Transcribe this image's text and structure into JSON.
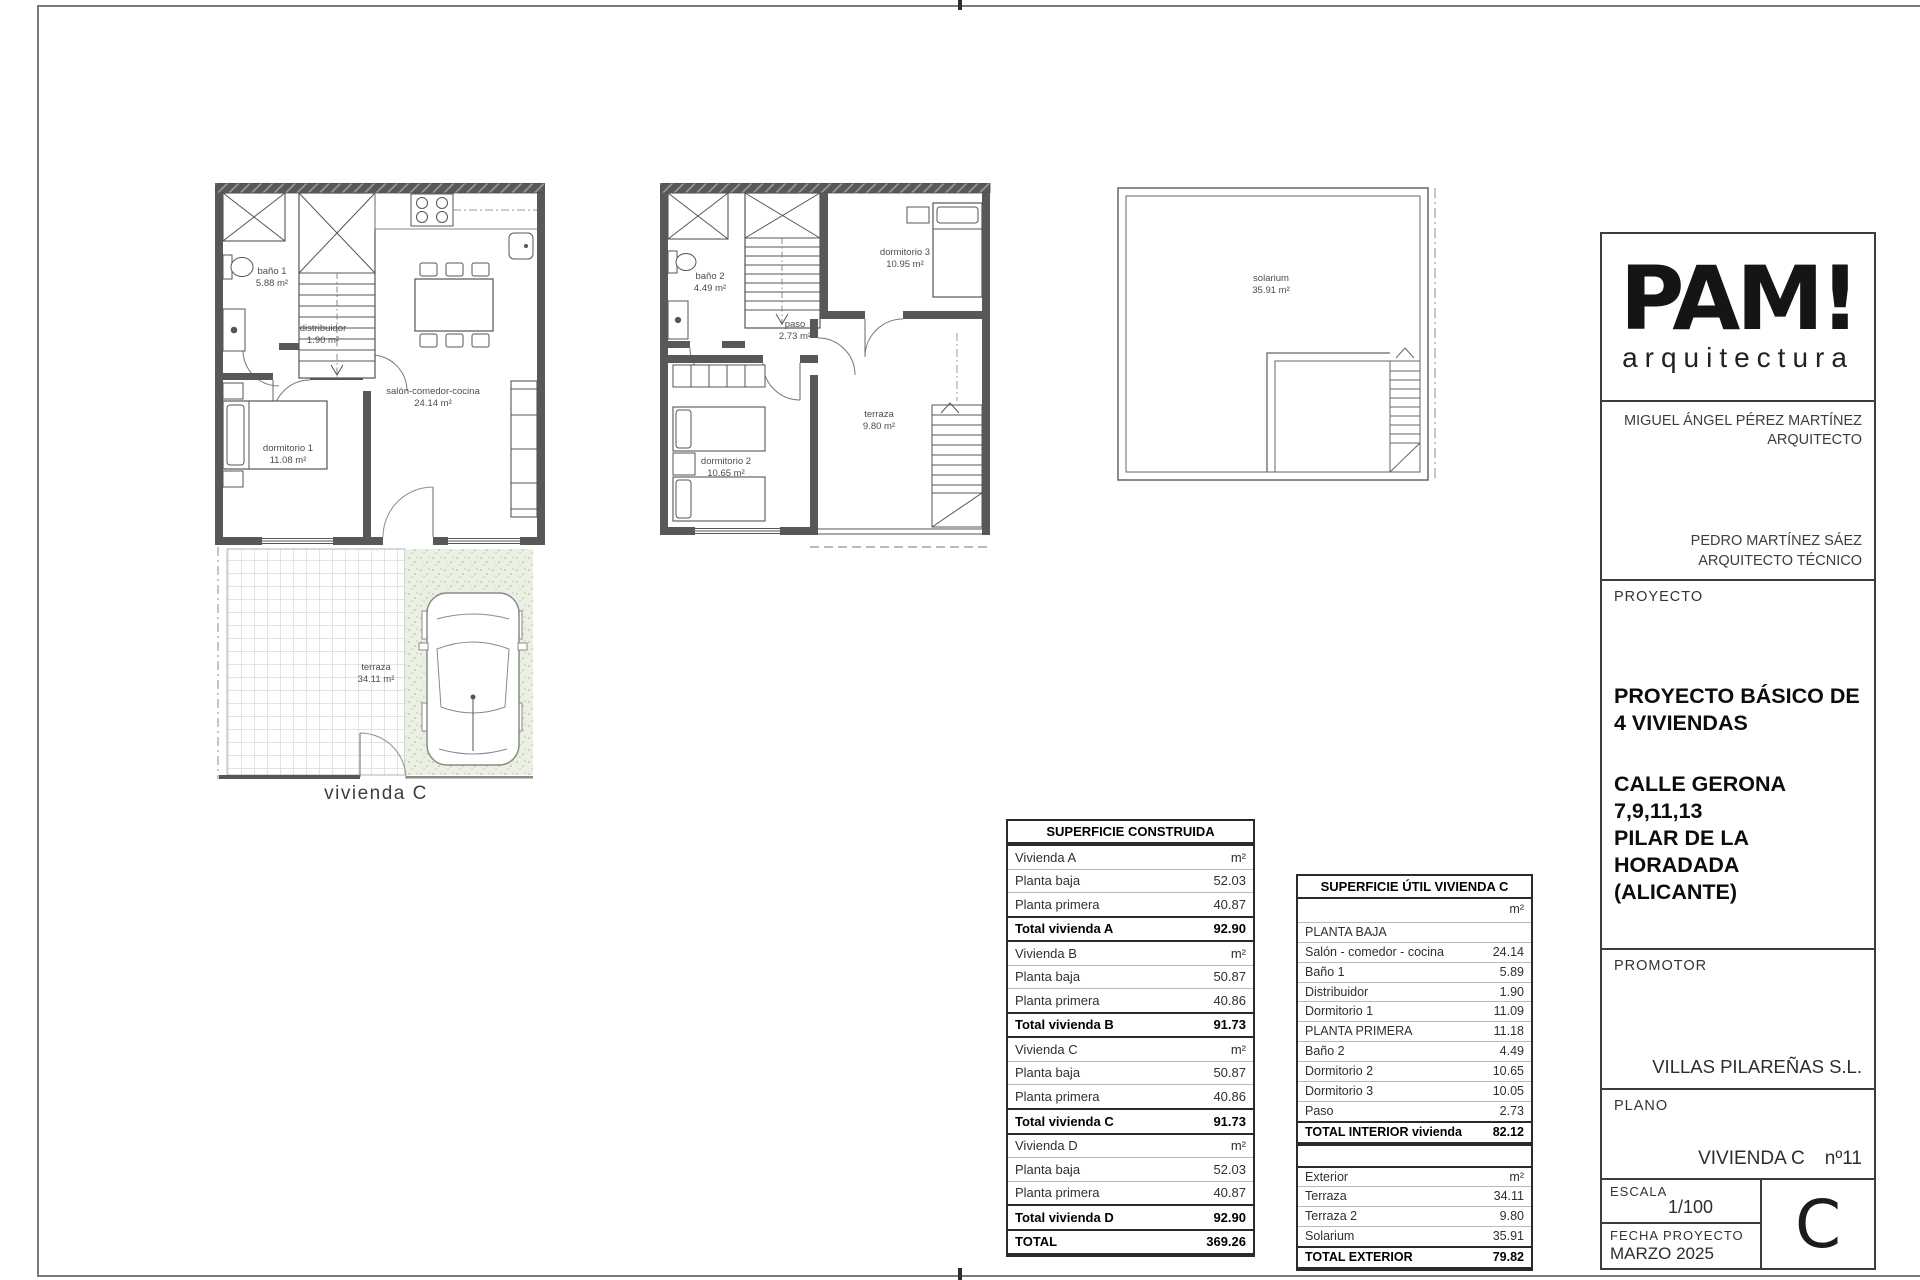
{
  "plans": {
    "ground": {
      "caption": "vivienda C",
      "bano1": {
        "name": "baño 1",
        "area": "5.88 m²"
      },
      "distribuidor": {
        "name": "distribuidor",
        "area": "1.90 m²"
      },
      "salon": {
        "name": "salón-comedor-cocina",
        "area": "24.14 m²"
      },
      "dorm1": {
        "name": "dormitorio 1",
        "area": "11.08 m²"
      },
      "terraza": {
        "name": "terraza",
        "area": "34.11 m²"
      }
    },
    "first": {
      "bano2": {
        "name": "baño 2",
        "area": "4.49 m²"
      },
      "dorm3": {
        "name": "dormitorio 3",
        "area": "10.95 m²"
      },
      "paso": {
        "name": "paso",
        "area": "2.73 m²"
      },
      "dorm2": {
        "name": "dormitorio 2",
        "area": "10.65 m²"
      },
      "terraza": {
        "name": "terraza",
        "area": "9.80 m²"
      }
    },
    "solarium": {
      "room": {
        "name": "solarium",
        "area": "35.91 m²"
      }
    }
  },
  "tables": {
    "construida": {
      "title": "SUPERFICIE CONSTRUIDA",
      "rows": [
        {
          "label": "Vivienda A",
          "value": "m²"
        },
        {
          "label": "Planta baja",
          "value": "52.03"
        },
        {
          "label": "Planta primera",
          "value": "40.87"
        },
        {
          "label": "Total vivienda A",
          "value": "92.90"
        },
        {
          "label": "Vivienda B",
          "value": "m²"
        },
        {
          "label": "Planta baja",
          "value": "50.87"
        },
        {
          "label": "Planta primera",
          "value": "40.86"
        },
        {
          "label": "Total vivienda B",
          "value": "91.73"
        },
        {
          "label": "Vivienda C",
          "value": "m²"
        },
        {
          "label": "Planta baja",
          "value": "50.87"
        },
        {
          "label": "Planta primera",
          "value": "40.86"
        },
        {
          "label": "Total vivienda C",
          "value": "91.73"
        },
        {
          "label": "Vivienda D",
          "value": "m²"
        },
        {
          "label": "Planta baja",
          "value": "52.03"
        },
        {
          "label": "Planta primera",
          "value": "40.87"
        },
        {
          "label": "Total vivienda D",
          "value": "92.90"
        },
        {
          "label": "TOTAL",
          "value": "369.26"
        }
      ]
    },
    "util": {
      "title": "SUPERFICIE ÚTIL VIVIENDA C",
      "unit": "m²",
      "rows": [
        {
          "label": "PLANTA BAJA",
          "value": ""
        },
        {
          "label": "Salón - comedor - cocina",
          "value": "24.14"
        },
        {
          "label": "Baño 1",
          "value": "5.89"
        },
        {
          "label": "Distribuidor",
          "value": "1.90"
        },
        {
          "label": "Dormitorio 1",
          "value": "11.09"
        },
        {
          "label": "PLANTA PRIMERA",
          "value": "11.18"
        },
        {
          "label": "Baño 2",
          "value": "4.49"
        },
        {
          "label": "Dormitorio 2",
          "value": "10.65"
        },
        {
          "label": "Dormitorio 3",
          "value": "10.05"
        },
        {
          "label": "Paso",
          "value": "2.73"
        }
      ],
      "total": {
        "label": "TOTAL INTERIOR vivienda",
        "value": "82.12"
      },
      "exterior": {
        "header": {
          "label": "Exterior",
          "value": "m²"
        },
        "rows": [
          {
            "label": "Terraza",
            "value": "34.11"
          },
          {
            "label": "Terraza 2",
            "value": "9.80"
          },
          {
            "label": "Solarium",
            "value": "35.91"
          }
        ],
        "total": {
          "label": "TOTAL EXTERIOR",
          "value": "79.82"
        }
      }
    }
  },
  "titleblock": {
    "logo": {
      "brand": "PAM!",
      "sub": "arquitectura"
    },
    "architect": {
      "name": "MIGUEL ÁNGEL PÉREZ MARTÍNEZ",
      "role": "ARQUITECTO"
    },
    "technical": {
      "name": "PEDRO MARTÍNEZ SÁEZ",
      "role": "ARQUITECTO TÉCNICO"
    },
    "proyecto": {
      "label": "PROYECTO",
      "title_line1": "PROYECTO BÁSICO DE",
      "title_line2": "4 VIVIENDAS",
      "addr_line1": "CALLE GERONA",
      "addr_line2": "7,9,11,13",
      "addr_line3": "PILAR DE LA HORADADA",
      "addr_line4": "(ALICANTE)"
    },
    "promotor": {
      "label": "PROMOTOR",
      "name": "VILLAS PILAREÑAS S.L."
    },
    "plano": {
      "label": "PLANO",
      "name": "VIVIENDA C",
      "number": "nº11"
    },
    "escala": {
      "label": "ESCALA",
      "value": "1/100"
    },
    "fecha": {
      "label": "FECHA PROYECTO",
      "value": "MARZO 2025"
    },
    "sheet_letter": "C"
  }
}
